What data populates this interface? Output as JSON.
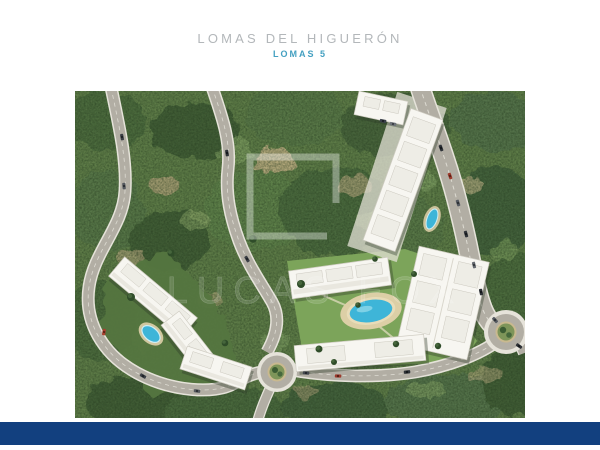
{
  "header": {
    "title": "LOMAS DEL HIGUERÓN",
    "subtitle": "LOMAS 5",
    "title_color": "#b3b7ba",
    "subtitle_color": "#44a0c1"
  },
  "footer": {
    "bar_color": "#12407f"
  },
  "aerial_image": {
    "kind": "aerial-masterplan-render",
    "alt": "Aerial render of the Lomas 5 residential development: white apartment blocks with communal pools and lawns set in Mediterranean scrubland, linked by curving roads, two roundabouts and passing cars",
    "watermark": {
      "logo": "lucas-fox-open-square-logo",
      "text": "LUCAS FOX",
      "color": "#ffffff"
    },
    "palette": {
      "vegetation": "#5d7b47",
      "vegetation_dark": "#3f5c35",
      "vegetation_light": "#8aa466",
      "earth": "#c2ae85",
      "road": "#b2aea4",
      "road_edge": "#e6e3da",
      "building": "#f7f6f1",
      "lawn": "#7ca45a",
      "pool": "#3eb5d8"
    },
    "elements": [
      "apartment-blocks-west-cluster",
      "apartment-blocks-center-cluster",
      "apartment-block-northeast",
      "communal-pool-west",
      "communal-pool-center",
      "pool-northeast",
      "roundabout-center",
      "roundabout-east",
      "access-roads",
      "cars"
    ]
  }
}
